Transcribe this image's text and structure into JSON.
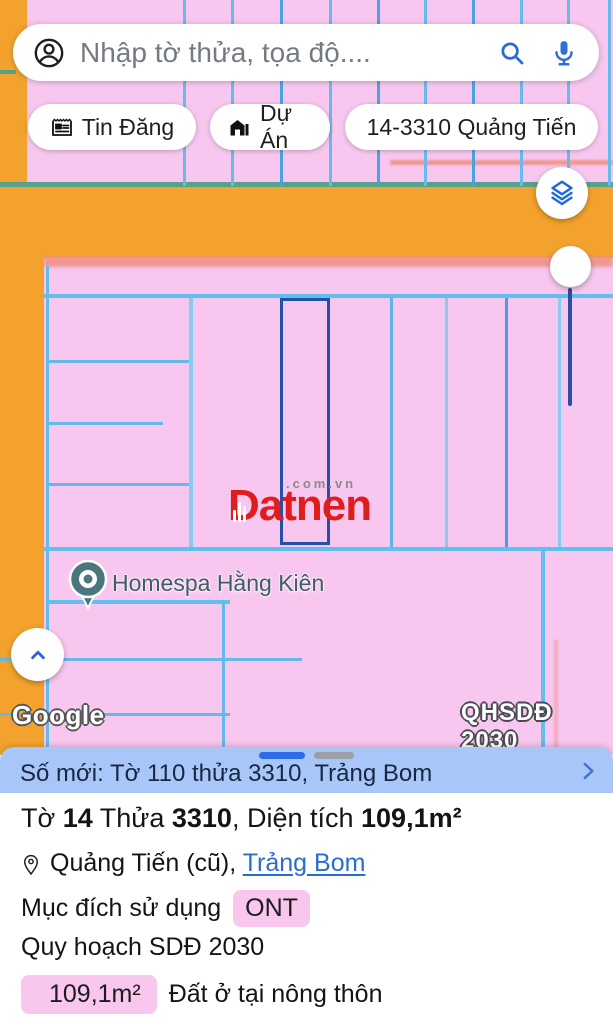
{
  "search": {
    "placeholder": "Nhập tờ thửa, tọa độ...."
  },
  "chips": [
    {
      "label": "Tin Đăng"
    },
    {
      "label": "Dự Án"
    },
    {
      "label": "14-3310 Quảng Tiến"
    }
  ],
  "map": {
    "watermark": {
      "brand": "Datnen",
      "suffix": ".com.vn"
    },
    "poi": {
      "label": "Homespa Hằng Kiên"
    },
    "attribution": {
      "google": "Google",
      "plan": "QHSDĐ 2030"
    }
  },
  "infobar": {
    "title": "Số mới: Tờ 110 thửa 3310, Trảng Bom"
  },
  "details": {
    "title": {
      "t1": "Tờ ",
      "b1": "14",
      "t2": " Thửa ",
      "b2": "3310",
      "t3": ", Diện tích ",
      "b3": "109,1m²"
    },
    "location": {
      "text": "Quảng Tiến (cũ), ",
      "link": "Trảng Bom"
    },
    "purpose": {
      "label": "Mục đích sử dụng",
      "badge": "ONT"
    },
    "planning": {
      "label": "Quy hoạch SDĐ 2030"
    },
    "area": {
      "badge": "109,1m²",
      "label": "Đất ở tại nông thôn"
    }
  },
  "colors": {
    "map_pink": "#f8c7ef",
    "map_orange": "#f3a32d",
    "road_edge_teal": "#55a18c",
    "parcel_cyan": "#63bbec",
    "selected_parcel_navy": "#2351a5",
    "salmon_line": "#ee8b7a",
    "infobar_blue": "#a8c6f8",
    "accent_blue": "#2e6bea",
    "badge_pink": "#f9c6ee",
    "link_blue": "#2b6cce",
    "watermark_red": "#df1d1d"
  }
}
